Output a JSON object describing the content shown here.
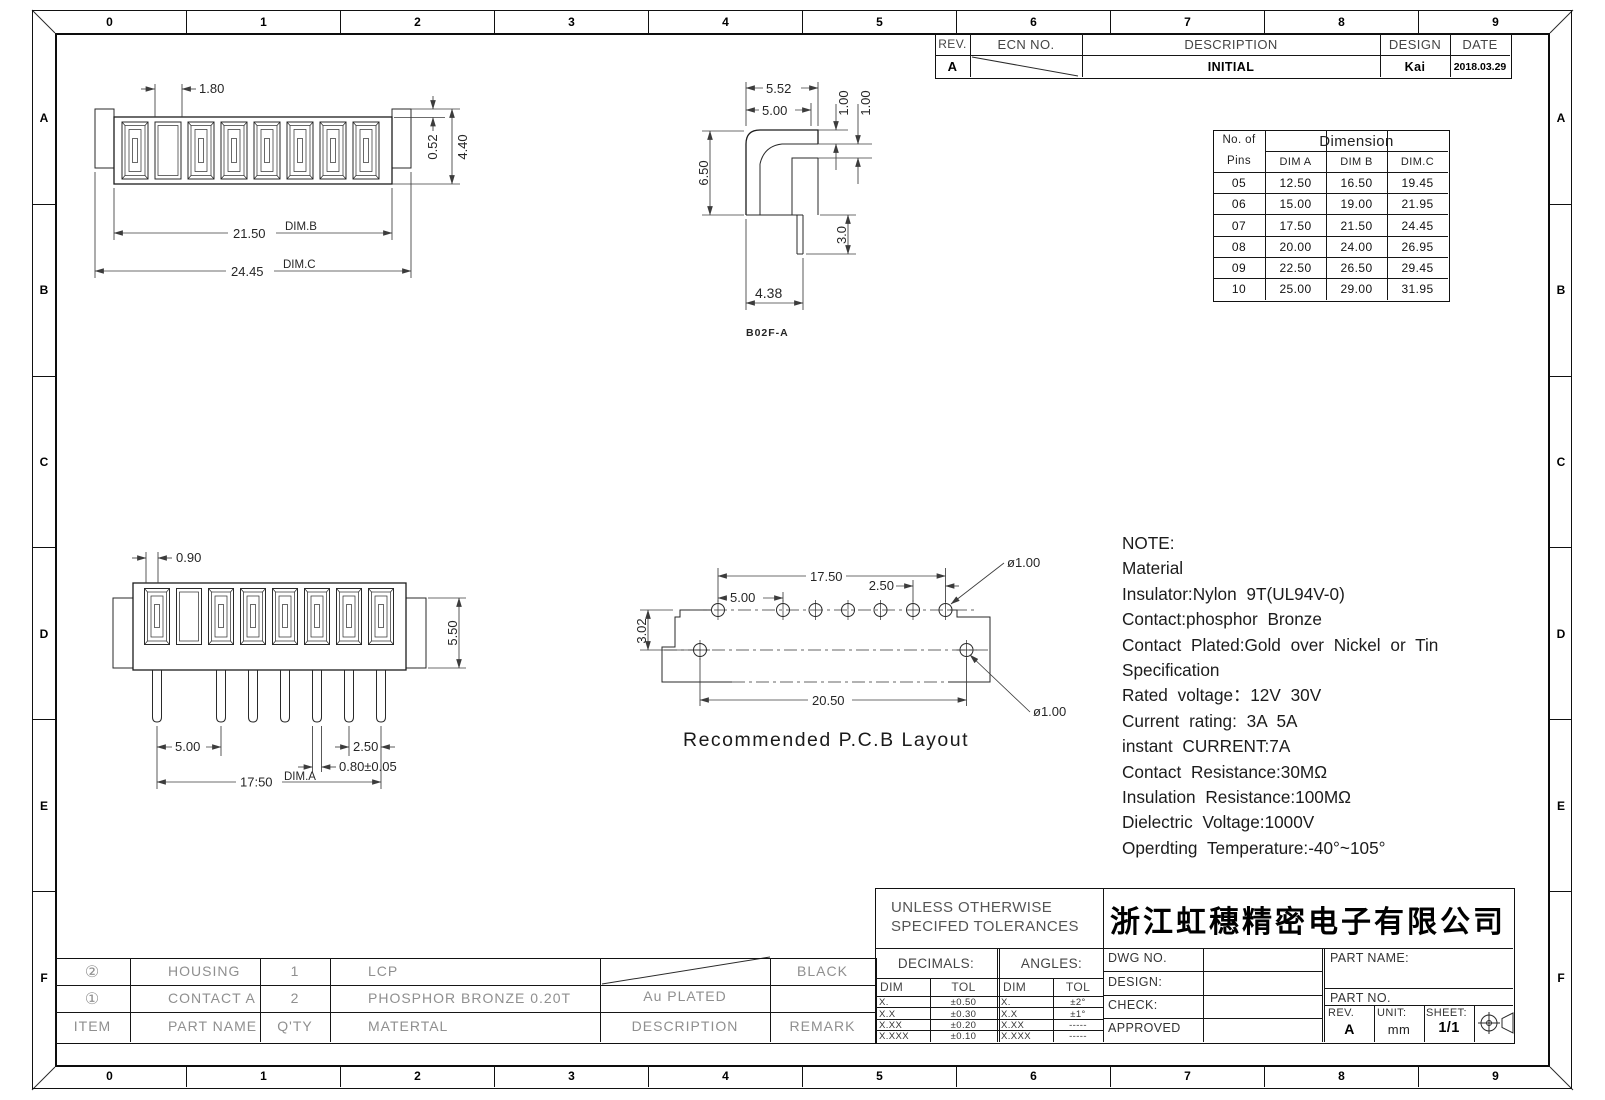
{
  "sheet": {
    "grid_cols": [
      "0",
      "1",
      "2",
      "3",
      "4",
      "5",
      "6",
      "7",
      "8",
      "9"
    ],
    "grid_rows": [
      "A",
      "B",
      "C",
      "D",
      "E",
      "F"
    ]
  },
  "rev_table": {
    "headers": {
      "rev": "REV.",
      "ecn": "ECN NO.",
      "description": "DESCRIPTION",
      "design": "DESIGN",
      "date": "DATE"
    },
    "row": {
      "rev": "A",
      "description": "INITIAL",
      "design": "Kai",
      "date": "2018.03.29"
    }
  },
  "dim_table": {
    "col1_title": "No. of",
    "col1_subtitle": "Pins",
    "title": "Dimension",
    "headers": [
      "DIM A",
      "DIM B",
      "DIM.C"
    ],
    "rows": [
      [
        "05",
        "12.50",
        "16.50",
        "19.45"
      ],
      [
        "06",
        "15.00",
        "19.00",
        "21.95"
      ],
      [
        "07",
        "17.50",
        "21.50",
        "24.45"
      ],
      [
        "08",
        "20.00",
        "24.00",
        "26.95"
      ],
      [
        "09",
        "22.50",
        "26.50",
        "29.45"
      ],
      [
        "10",
        "25.00",
        "29.00",
        "31.95"
      ]
    ]
  },
  "drawings": {
    "top_view": {
      "slot_width": "1.80",
      "wall": "0.52",
      "height": "4.40",
      "dim_b": "21.50",
      "dim_b_name": "DIM.B",
      "dim_c": "24.45",
      "dim_c_name": "DIM.C"
    },
    "side_view": {
      "width": "5.52",
      "inner_width": "5.00",
      "t1": "1.00",
      "t2": "1.00",
      "height": "6.50",
      "pin": "3.0",
      "base": "4.38",
      "code": "B02F-A"
    },
    "front_view": {
      "slot": "0.90",
      "height": "5.50",
      "pitch1": "5.00",
      "pitch2": "2.50",
      "pin": "0.80±0.05",
      "dim_a": "17:50",
      "dim_a_name": "DIM.A"
    },
    "pcb": {
      "span": "17.50",
      "pitch1": "5.00",
      "pitch2": "2.50",
      "hole_top": "ø1.00",
      "row_offset": "3.02",
      "mount_span": "20.50",
      "hole_bottom": "ø1.00",
      "caption": "Recommended P.C.B Layout"
    }
  },
  "note": {
    "lines": [
      "NOTE:",
      "Material",
      "Insulator:Nylon 9T(UL94V-0)",
      "Contact:phosphor Bronze",
      "Contact Plated:Gold over Nickel or Tin",
      "Specification",
      "Rated voltage：12V 30V",
      "Current rating: 3A   5A",
      "instant CURRENT:7A",
      "Contact Resistance:30MΩ",
      "Insulation Resistance:100MΩ",
      "Dielectric Voltage:1000V",
      "Operdting Temperature:-40°~105°"
    ]
  },
  "parts_table": {
    "headers": [
      "ITEM",
      "PART NAME",
      "Q'TY",
      "MATERTAL",
      "DESCRIPTION",
      "REMARK"
    ],
    "rows": [
      {
        "item": "②",
        "name": "HOUSING",
        "qty": "1",
        "material": "LCP",
        "description": "",
        "remark": "BLACK"
      },
      {
        "item": "①",
        "name": "CONTACT A",
        "qty": "2",
        "material": "PHOSPHOR BRONZE 0.20T",
        "description": "Au PLATED",
        "remark": ""
      }
    ]
  },
  "title_block": {
    "tolerances_title_1": "UNLESS OTHERWISE",
    "tolerances_title_2": "SPECIFED TOLERANCES",
    "company": "浙江虹穗精密电子有限公司",
    "decimals": "DECIMALS:",
    "angles": "ANGLES:",
    "dim": "DIM",
    "tol": "TOL",
    "decimal_rows": [
      [
        "X.",
        "±0.50"
      ],
      [
        "X.X",
        "±0.30"
      ],
      [
        "X.XX",
        "±0.20"
      ],
      [
        "X.XXX",
        "±0.10"
      ]
    ],
    "angle_rows": [
      [
        "X.",
        "±2°"
      ],
      [
        "X.X",
        "±1°"
      ],
      [
        "X.XX",
        "-----"
      ],
      [
        "X.XXX",
        "-----"
      ]
    ],
    "dwg_no": "DWG NO.",
    "design": "DESIGN:",
    "check": "CHECK:",
    "approved": "APPROVED",
    "part_name": "PART NAME:",
    "part_no": "PART NO.",
    "rev": "REV.",
    "rev_value": "A",
    "unit": "UNIT:",
    "unit_value": "mm",
    "sheet": "SHEET:",
    "sheet_value": "1/1"
  }
}
